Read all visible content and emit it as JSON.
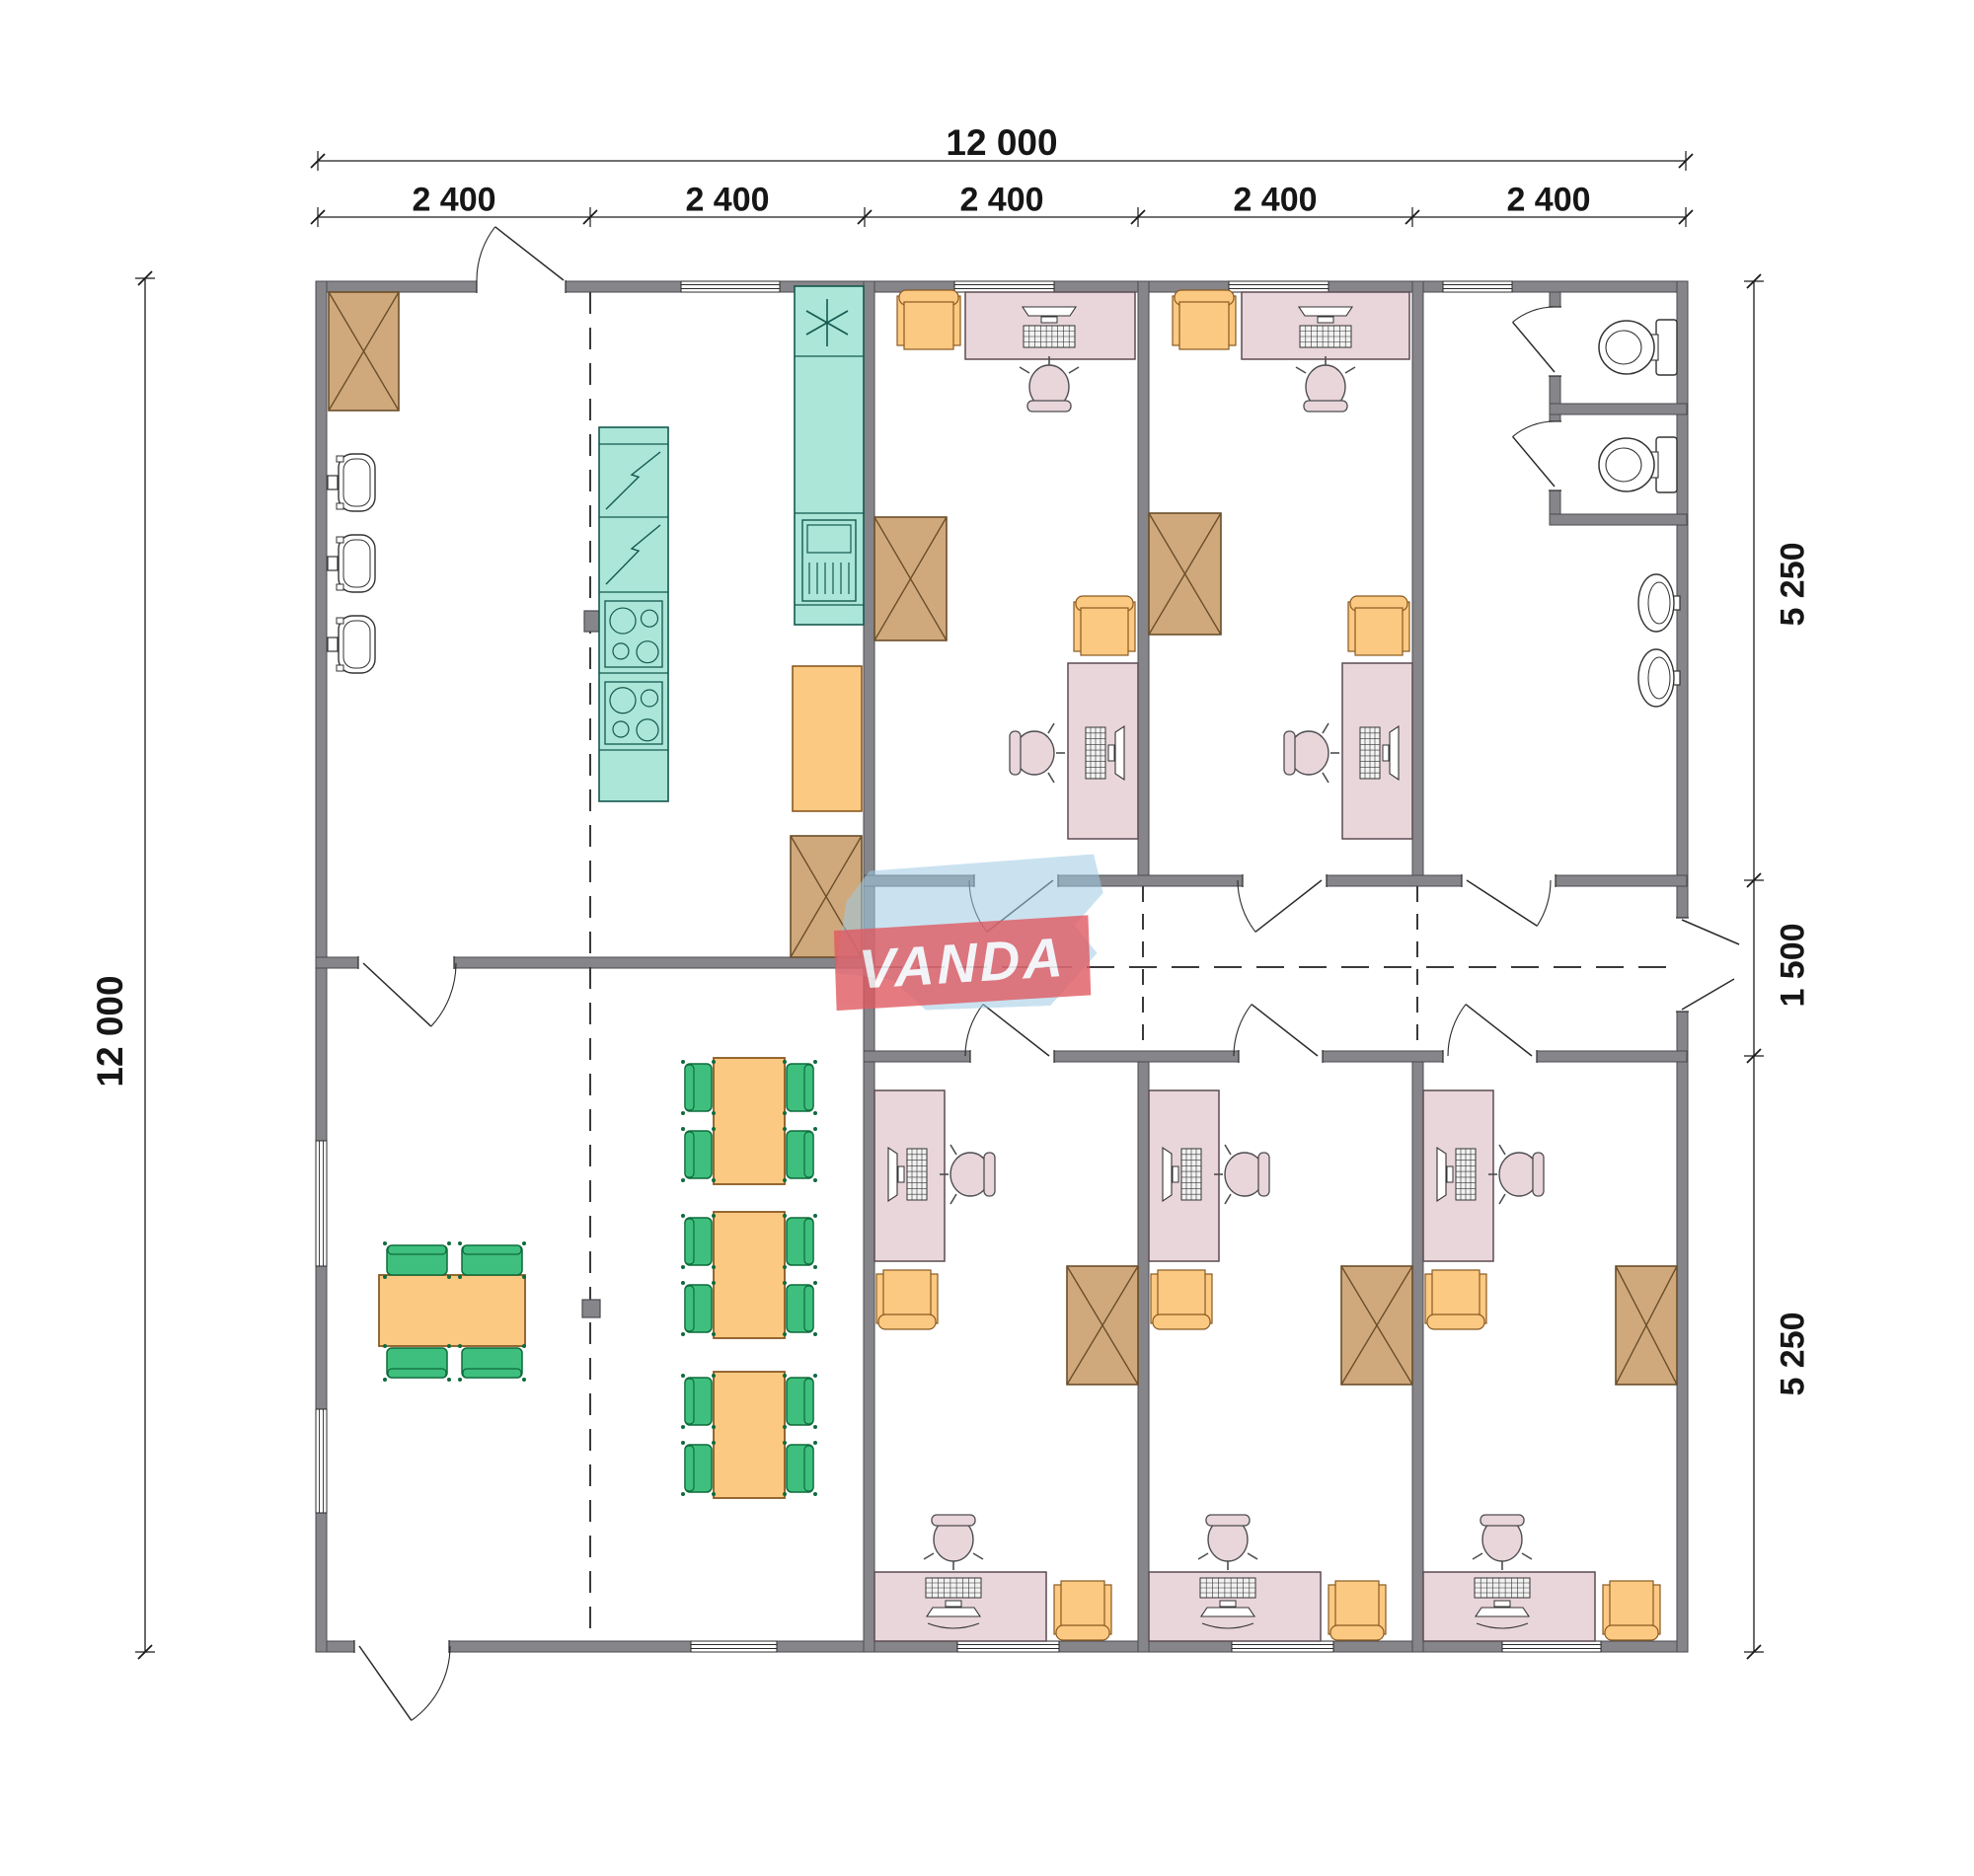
{
  "page": {
    "background": "#ffffff"
  },
  "dimensions": {
    "top_total": "12 000",
    "top_segments": [
      "2 400",
      "2 400",
      "2 400",
      "2 400",
      "2 400"
    ],
    "left_total": "12 000",
    "right_segments": [
      "5 250",
      "1 500",
      "5 250"
    ]
  },
  "logo": {
    "text": "VANDA",
    "shape_color": "#9ecbe4",
    "band_color": "#e05a62",
    "text_color": "#ffffff"
  },
  "colors": {
    "wall": "#85858a",
    "wall_edge": "#4a4a50",
    "tan": "#cfa97c",
    "tan_edge": "#6b4e2a",
    "teal": "#abe6d9",
    "teal_edge": "#14594e",
    "orange": "#fbc981",
    "orange_edge": "#8a5a22",
    "pink": "#e9d6da",
    "pink_edge": "#5c4c52",
    "green": "#3fbf7d",
    "green_edge": "#0f6b3c",
    "line": "#2b2b2b",
    "dim_line": "#1a1a1a",
    "fixture": "#333333"
  },
  "legend": {
    "x-box": "storage-cabinet",
    "teal-units": "kitchen appliances and sink counter",
    "pink-rect": "office desk with computer",
    "orange-square": "visitor armchair",
    "green-rect": "dining chair",
    "asterisk": "cooker-hood / light symbol"
  },
  "rooms": [
    {
      "id": "kitchen",
      "furniture": [
        "storage-cabinet",
        "wall-sink",
        "wall-sink",
        "wall-sink",
        "fridge-column",
        "cooktop-block",
        "counter-with-sink",
        "service-table",
        "storage-cabinet"
      ]
    },
    {
      "id": "office-top-1",
      "furniture": [
        "armchair",
        "desk-with-computer",
        "office-chair",
        "storage-cabinet",
        "armchair",
        "desk-with-computer",
        "office-chair"
      ]
    },
    {
      "id": "office-top-2",
      "furniture": [
        "armchair",
        "desk-with-computer",
        "office-chair",
        "storage-cabinet",
        "armchair",
        "desk-with-computer",
        "office-chair"
      ]
    },
    {
      "id": "sanitary",
      "furniture": [
        "toilet",
        "toilet",
        "wash-basin",
        "wash-basin"
      ]
    },
    {
      "id": "dining",
      "furniture": [
        "table-4-chairs",
        "table-4-chairs",
        "table-4-chairs",
        "table-4-chairs"
      ]
    },
    {
      "id": "office-bottom-1",
      "furniture": [
        "desk-with-computer",
        "office-chair",
        "armchair",
        "storage-cabinet",
        "desk-with-computer",
        "office-chair",
        "armchair"
      ]
    },
    {
      "id": "office-bottom-2",
      "furniture": [
        "desk-with-computer",
        "office-chair",
        "armchair",
        "storage-cabinet",
        "desk-with-computer",
        "office-chair",
        "armchair"
      ]
    },
    {
      "id": "office-bottom-3",
      "furniture": [
        "desk-with-computer",
        "office-chair",
        "armchair",
        "storage-cabinet",
        "desk-with-computer",
        "office-chair",
        "armchair"
      ]
    }
  ]
}
